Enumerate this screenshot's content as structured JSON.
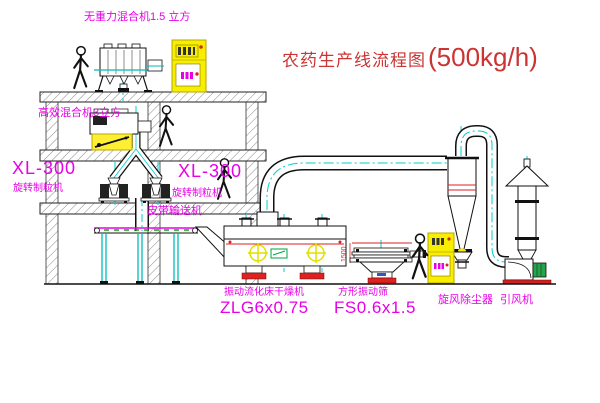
{
  "title": {
    "name": "农药生产线流程图",
    "capacity": "(500kg/h)"
  },
  "equipment_labels": {
    "gravity_free_mixer": "无重力混合机1.5 立方",
    "high_efficiency_mixer": "高效混合机3立方",
    "granulator_left_model": "XL-300",
    "granulator_left_type": "旋转制粒机",
    "granulator_right_model": "XL-300",
    "granulator_right_type": "旋转制粒机",
    "belt_conveyor": "皮带输送机",
    "fluid_bed_dryer": "振动流化床干燥机",
    "fluid_bed_dryer_model": "ZLG6x0.75",
    "square_vibrating_screen": "方形振动筛",
    "square_vibrating_screen_model": "FS0.6x1.5",
    "cyclone_dust_collector": "旋风除尘器",
    "induced_draft_fan": "引风机"
  },
  "annotations": {
    "screen_dimension": "1500"
  },
  "colors": {
    "label_magenta": "#e800e8",
    "title_red": "#cc3333",
    "centerline_cyan": "#00cccc",
    "cabinet_yellow": "#f8ef00",
    "alert_red": "#dd2222",
    "motor_green": "#28a24c",
    "conveyor_green": "#00aa00"
  }
}
